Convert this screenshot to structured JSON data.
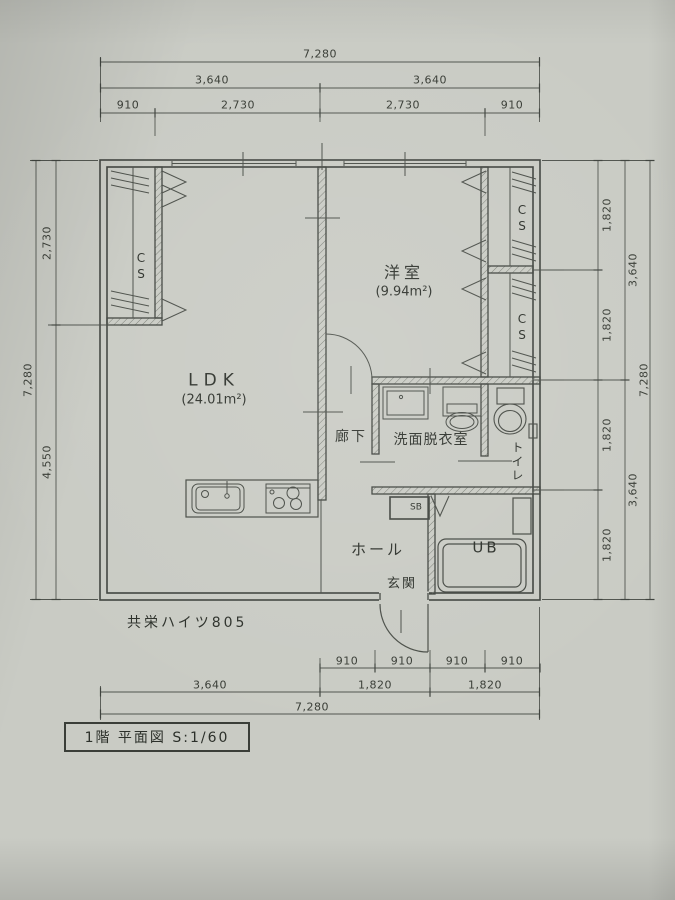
{
  "colors": {
    "paper": "#c9cbc4",
    "line": "#3f433e",
    "dim_line": "#50544e",
    "text": "#2e322c"
  },
  "title_block": {
    "text": "1階 平面図 S:1/60"
  },
  "building": {
    "name": "共栄ハイツ805"
  },
  "rooms": {
    "ldk": {
      "name": "LDK",
      "area": "(24.01m²)"
    },
    "western_room": {
      "name": "洋室",
      "area": "(9.94m²)"
    },
    "corridor": {
      "name": "廊下"
    },
    "washroom": {
      "name": "洗面脱衣室"
    },
    "toilet": {
      "name": "トイレ"
    },
    "hall": {
      "name": "ホール"
    },
    "entrance": {
      "name": "玄関"
    },
    "unit_bath": {
      "name": "UB"
    },
    "shoe_box": {
      "name": "SB"
    },
    "closet_left": {
      "name": "CS"
    },
    "closet_right_top": {
      "name": "CS"
    },
    "closet_right_bottom": {
      "name": "CS"
    }
  },
  "dimensions": {
    "top": {
      "total": "7,280",
      "halves": [
        "3,640",
        "3,640"
      ],
      "segments": [
        "910",
        "2,730",
        "2,730",
        "910"
      ]
    },
    "left": {
      "total": "7,280",
      "segments": [
        "2,730",
        "4,550"
      ]
    },
    "right": {
      "total": "7,280",
      "halves": [
        "3,640",
        "3,640"
      ],
      "segments": [
        "1,820",
        "1,820",
        "1,820",
        "1,820"
      ]
    },
    "bottom": {
      "total": "7,280",
      "mid": [
        "3,640",
        "1,820",
        "1,820"
      ],
      "segments": [
        "910",
        "910",
        "910",
        "910"
      ]
    }
  }
}
